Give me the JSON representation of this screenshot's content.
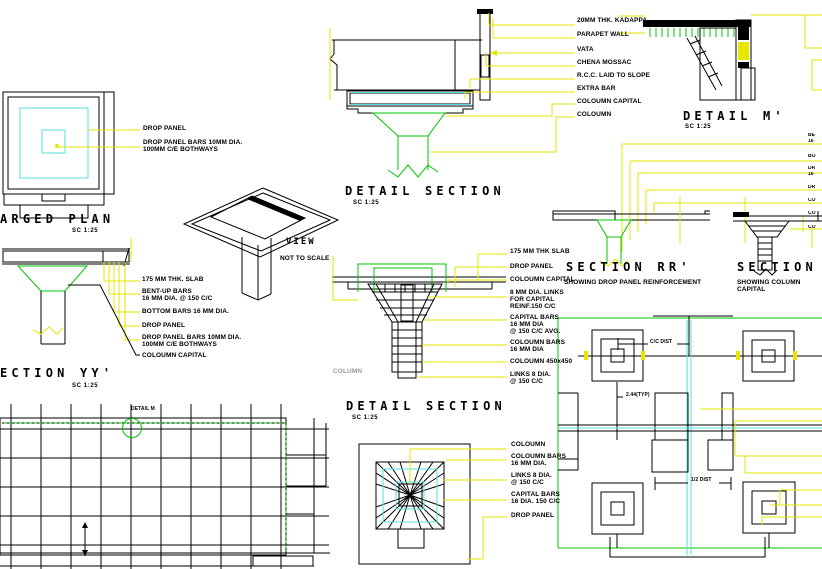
{
  "colors": {
    "line": "#000000",
    "green": "#00c400",
    "cyan": "#55dede",
    "magenta": "#e800e8",
    "yellow": "#e6e600",
    "ghost": "#9a9a9a"
  },
  "enlarged_plan": {
    "title": "ARGED PLAN",
    "scale": "SC 1:25",
    "labels": {
      "drop_panel": "DROP PANEL",
      "drop_panel_bars": "DROP PANEL BARS 10MM DIA.\n100MM C/E BOTHWAYS"
    }
  },
  "roof_section": {
    "title": "DETAIL SECTION",
    "scale": "SC 1:25",
    "labels": {
      "kadappa": "20MM THK. KADAPPA",
      "parapet": "PARAPET WALL",
      "vata": "VATA",
      "chena": "CHENA MOSSAC",
      "rcc": "R.C.C. LAID TO SLOPE",
      "extra_bar": "EXTRA BAR",
      "capital": "COLOUMN CAPITAL",
      "column": "COLOUMN"
    }
  },
  "detail_m_section": {
    "title": "DETAIL M'",
    "scale": "SC 1:25"
  },
  "view_3d": {
    "title": "VIEW",
    "subtitle": "NOT TO SCALE"
  },
  "section_yy": {
    "title": "ECTION YY'",
    "scale": "SC 1:25",
    "labels": {
      "slab": "175 MM THK. SLAB",
      "bentup": "BENT-UP BARS\n16 MM DIA. @ 150 C/C",
      "bottom": "BOTTOM BARS 16 MM DIA.",
      "drop": "DROP PANEL",
      "drop_bars": "DROP PANEL BARS 10MM DIA.\n100MM C/E BOTHWAYS",
      "capital": "COLOUMN CAPITAL"
    }
  },
  "section_rr": {
    "title": "SECTION RR'",
    "subtitle": "SHOWING DROP PANEL REINFORCEMENT"
  },
  "section_right": {
    "title": "SECTION",
    "subtitle": "SHOWING COLUMN CAPITAL"
  },
  "capital_section": {
    "title": "DETAIL SECTION",
    "scale": "SC 1:25",
    "column_ghost": "COLUMN",
    "labels": {
      "slab": "175 MM THK SLAB",
      "drop": "DROP PANEL",
      "capital": "COLOUMN CAPITAL",
      "links": "8 MM DIA. LINKS\nFOR CAPITAL\nREINF.150 C/C",
      "capital_bars": "CAPITAL BARS\n16 MM DIA\n@ 150 C/C AVG.",
      "column_bars": "COLOUMN BARS\n16 MM DIA",
      "column_size": "COLOUMN 450x450",
      "links2": "LINKS 8 DIA.\n@ 150 C/C"
    }
  },
  "capital_plan": {
    "labels": {
      "column": "COLOUMN",
      "column_bars": "COLOUMN BARS\n16 MM DIA.",
      "links": "LINKS 8 DIA.\n@ 150 C/C",
      "capital_bars": "CAPITAL BARS\n16 DIA. 150 C/C",
      "drop": "DROP PANEL"
    }
  },
  "floor_plan": {
    "detail_ref": "DETAIL M"
  },
  "column_layout": {
    "dims": {
      "cc": "C/C DIST",
      "typ": "2.44(TYP)",
      "half": "1/2 DIST"
    }
  },
  "edge_fragments": [
    "BE",
    "16",
    "BO",
    "DR",
    "16",
    "DR",
    "CO",
    "CO",
    "CO"
  ]
}
